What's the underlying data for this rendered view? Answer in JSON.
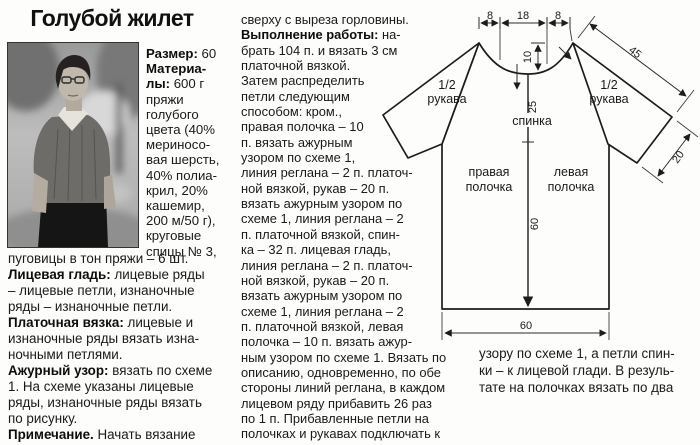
{
  "theme": {
    "paper": "#fdfdfc",
    "ink": "#1a1a1a"
  },
  "title": "Голубой жилет",
  "left_column": {
    "photo": {
      "description": "black-and-white photo of woman wearing the blue vest outdoors"
    },
    "materials_lines": [
      "**Размер:** 60",
      "**Материа-**",
      "**лы:** 600 г",
      "пряжи",
      "голубого",
      "цвета (40%",
      "мериносо-",
      "вая шерсть,",
      "40% полиа-",
      "крил, 20%",
      "кашемир,",
      "200 м/50 г),",
      "круговые",
      "спицы № 3,"
    ],
    "notions_lines": [
      "пуговицы в тон пряжи – 6 шт.",
      "**Лицевая гладь:** лицевые ряды",
      "– лицевые петли, изнаночные",
      "ряды – изнаночные петли.",
      "**Платочная вязка:** лицевые и",
      "изнаночные ряды вязать изна-",
      "ночными петлями.",
      "**Ажурный узор:** вязать по схеме",
      "1. На схеме указаны лицевые",
      "ряды, изнаночные ряды вязать",
      "по рисунку.",
      "**Примечание.** Начать вязание"
    ]
  },
  "middle_column": {
    "instruction_lines": [
      "сверху с выреза горловины.",
      "**Выполнение работы:** на-",
      "брать 104 п. и вязать 3 см",
      "платочной вязкой.",
      "Затем распределить",
      "петли следующим",
      "способом: кром.,",
      "правая полочка – 10",
      "п. вязать ажурным",
      "узором по схеме 1,",
      "линия реглана – 2 п. платоч-",
      "ной вязкой,  рукав – 20 п.",
      "вязать ажурным узором по",
      "схеме 1, линия реглана – 2",
      "п. платочной вязкой,  спин-",
      "ка – 32 п. лицевая гладь,",
      "линия реглана – 2 п. платоч-",
      "ной вязкой,  рукав – 20 п.",
      "вязать ажурным узором по",
      "схеме 1,  линия реглана – 2",
      "п. платочной вязкой,  левая",
      "полочка – 10 п. вязать ажур-",
      "ным узором по схеме 1. Вязать по",
      "описанию, одновременно, по обе",
      "стороны линий реглана, в каждом",
      "лицевом ряду прибавить 26 раз",
      "по 1 п. Прибавленные петли на",
      "полочках и рукавах подключать к"
    ]
  },
  "bottom_right_column": {
    "continuation_lines": [
      "узору по схеме 1, а петли спин-",
      "ки – к лицевой глади. В резуль-",
      "тате на полочках вязать по два"
    ]
  },
  "diagram": {
    "labels": {
      "sleeve_line1": "1/2",
      "sleeve_line2": "рукава",
      "back": "спинка",
      "front_right_line1": "правая",
      "front_right_line2": "полочка",
      "front_left_line1": "левая",
      "front_left_line2": "полочка"
    },
    "dims": {
      "neck_front": "8",
      "neck_back": "18",
      "neck_front2": "8",
      "neck_depth": "10",
      "yoke_depth": "25",
      "body_length": "60",
      "hem_width": "60",
      "sleeve_length": "45",
      "cuff_width": "20"
    }
  }
}
